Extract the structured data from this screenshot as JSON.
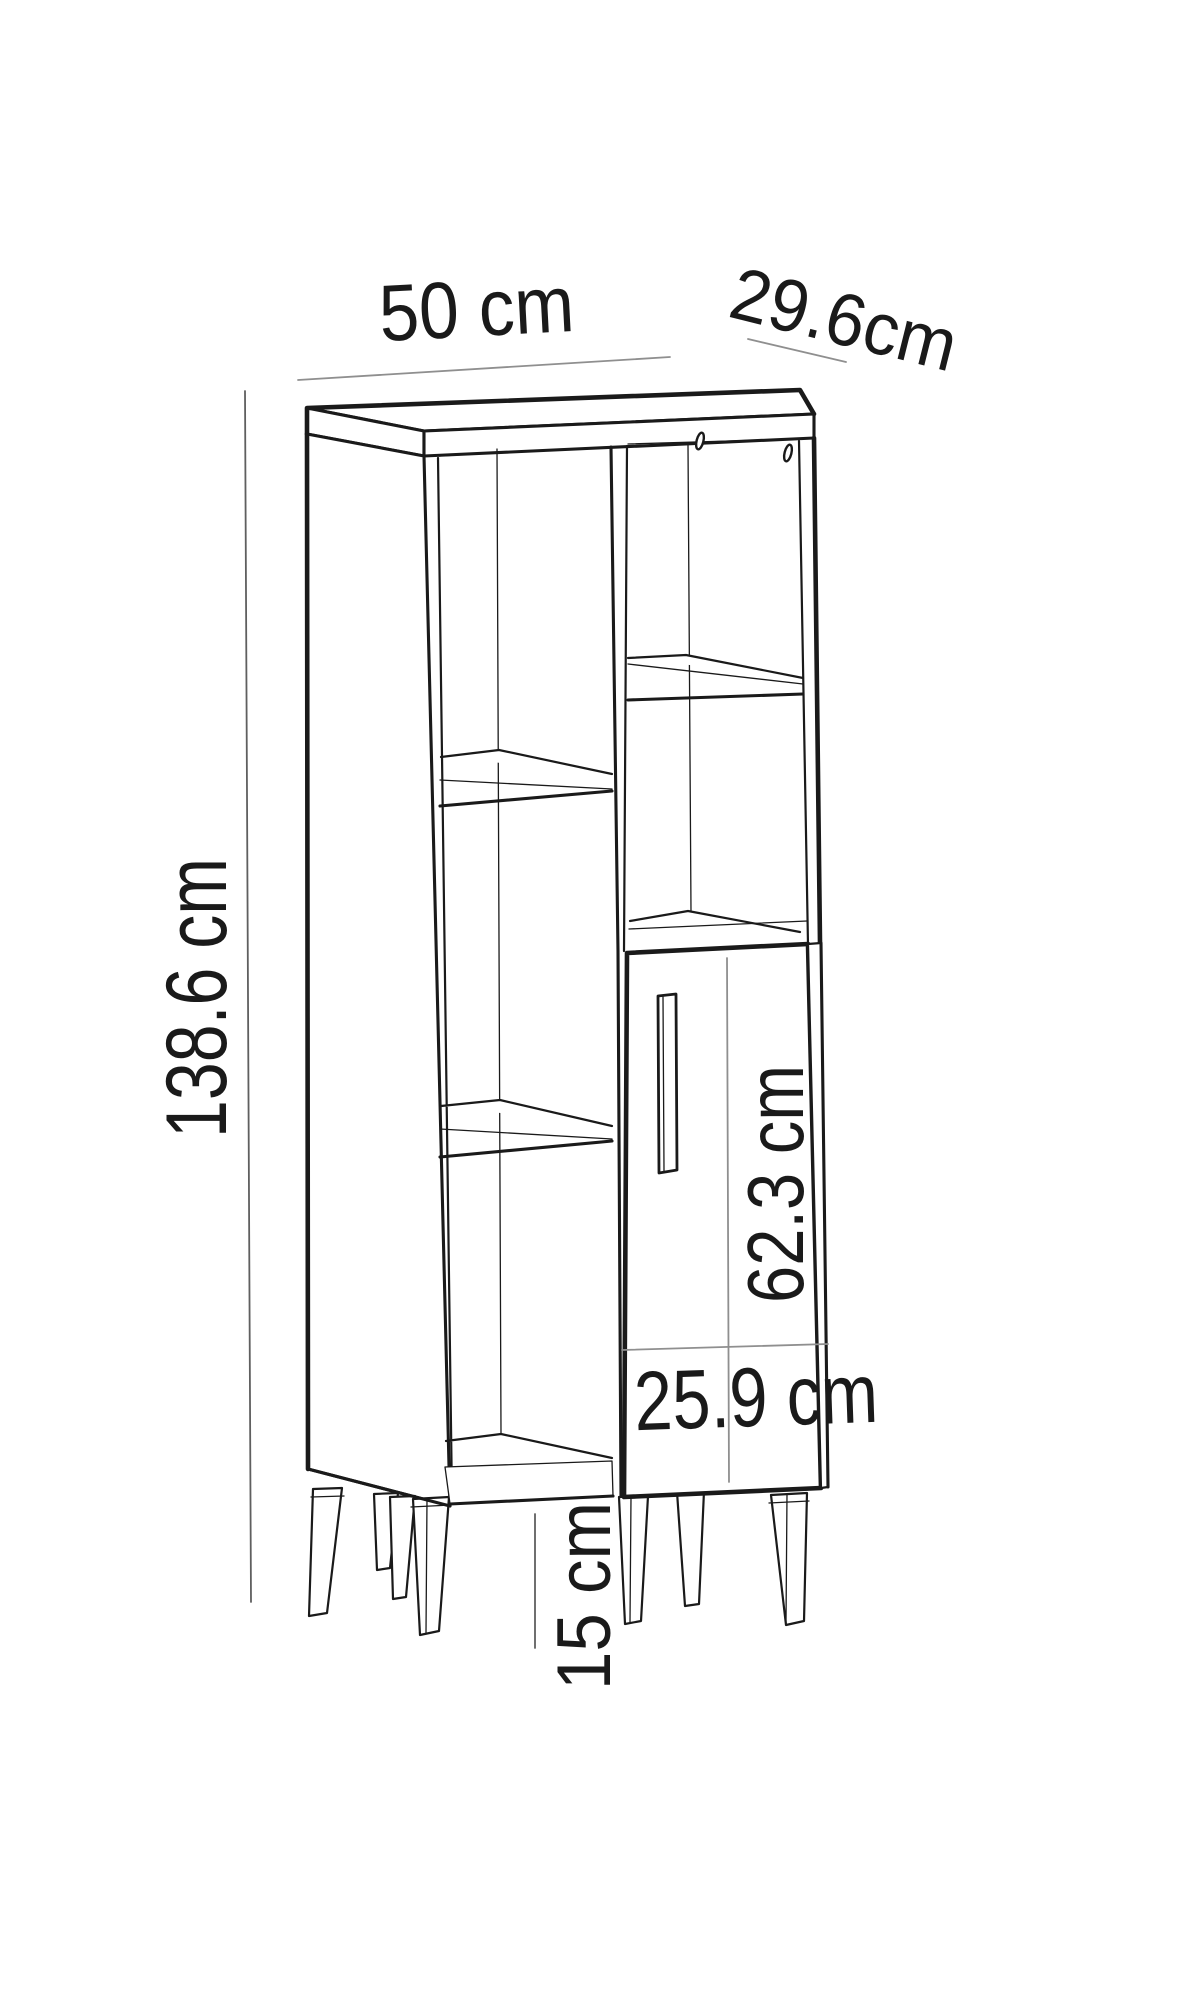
{
  "diagram": {
    "type": "furniture-technical-drawing",
    "subject": "tall bookcase cabinet with open shelves, lower door and splayed legs",
    "units": "cm"
  },
  "dimensions": {
    "width": {
      "label": "50 cm",
      "value": 50
    },
    "depth": {
      "label": "29.6cm",
      "value": 29.6
    },
    "height": {
      "label": "138.6 cm",
      "value": 138.6
    },
    "door_height": {
      "label": "62.3 cm",
      "value": 62.3
    },
    "door_width": {
      "label": "25.9 cm",
      "value": 25.9
    },
    "leg_height": {
      "label": "15 cm",
      "value": 15
    }
  },
  "colors": {
    "background": "#ffffff",
    "ink": "#1a1a1a",
    "dimension_line": "#8f8f8f",
    "dimension_line_dark": "#5f5f5f"
  }
}
